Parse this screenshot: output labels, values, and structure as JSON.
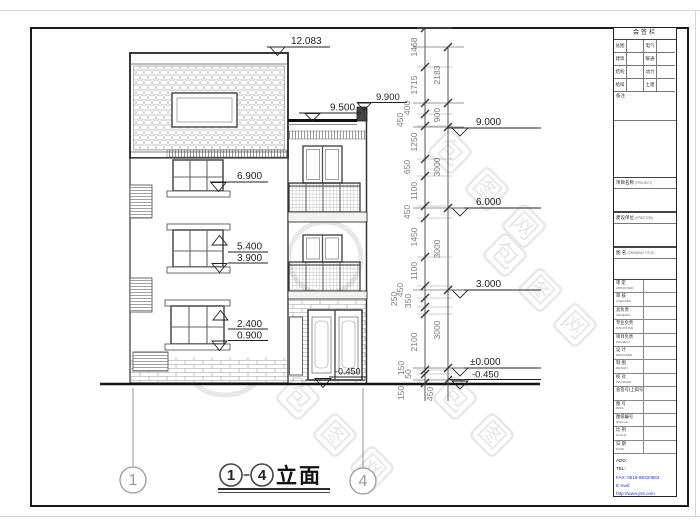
{
  "drawing": {
    "title_label": "立面",
    "title_dash": "-",
    "grid_bubble_left": "1",
    "grid_bubble_right": "4",
    "markers_building": {
      "roof_top": "12.083",
      "parapet": "9.900",
      "roof_deck": "9.500",
      "w3_sill": "6.900",
      "w2_top": "5.400",
      "w2_sill": "3.900",
      "w1_top": "2.400",
      "w1_sill": "0.900",
      "entry": "-0.450"
    },
    "levels_right": [
      "9.000",
      "6.000",
      "3.000",
      "±0.000",
      "-0.450"
    ],
    "dim_chain_inner": [
      "1468",
      "1715",
      "400",
      "450",
      "1250",
      "650",
      "1100",
      "450",
      "1450",
      "1100",
      "450",
      "350",
      "250",
      "2100",
      "150",
      "50",
      "150"
    ],
    "dim_chain_outer": [
      "2183",
      "900",
      "3000",
      "3000",
      "3000",
      "450"
    ]
  },
  "watermark": {
    "char1": "包",
    "char2": "图",
    "char3": "网"
  },
  "title_block": {
    "sign_bar": {
      "title": "会签栏",
      "rows": [
        [
          "总图",
          "电气"
        ],
        [
          "建筑",
          "暖通"
        ],
        [
          "结构",
          "动力"
        ],
        [
          "给排水",
          "土建"
        ]
      ],
      "note_label": "备注"
    },
    "sections": [
      {
        "label": "项目名称",
        "sub": "(PROJECT)"
      },
      {
        "label": "建设单位",
        "sub": "(ERECTOR)"
      },
      {
        "label": "图 名",
        "sub": "(DRAWING TITLE)"
      }
    ],
    "rows": [
      {
        "cn": "审 定",
        "en": "APPROVED"
      },
      {
        "cn": "审 核",
        "en": "CHECKED"
      },
      {
        "cn": "总负责",
        "en": "GENERAL"
      },
      {
        "cn": "专业负责",
        "en": "DISCIPLINE"
      },
      {
        "cn": "项目负责",
        "en": "PROJECT"
      },
      {
        "cn": "设 计",
        "en": "DESIGNED"
      },
      {
        "cn": "制 图",
        "en": "DRAWN"
      },
      {
        "cn": "校 对",
        "en": "PROOFED"
      },
      {
        "cn": "会签号(上岗号)",
        "en": ""
      },
      {
        "cn": "图 号",
        "en": "DWG"
      },
      {
        "cn": "图纸编号",
        "en": "DWG No."
      },
      {
        "cn": "比 例",
        "en": "SCALE"
      },
      {
        "cn": "日 期",
        "en": "DATE"
      }
    ],
    "contact": {
      "add": "ADD:",
      "tel": "TEL:",
      "fax": "FAX: 0519-88320563",
      "email": "E-mail:",
      "web": "http://www.jrrs.com"
    }
  }
}
